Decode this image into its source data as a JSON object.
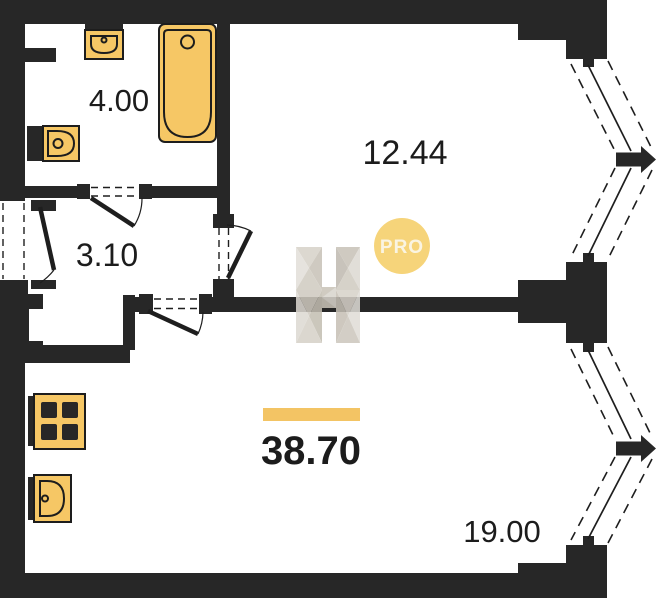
{
  "plan": {
    "type": "apartment-floor-plan",
    "rooms": [
      {
        "id": "bathroom",
        "area_label": "4.00"
      },
      {
        "id": "hallway",
        "area_label": "3.10"
      },
      {
        "id": "room-top",
        "area_label": "12.44"
      },
      {
        "id": "room-bottom",
        "area_label": "19.00"
      },
      {
        "id": "total-area",
        "area_label": "38.70"
      }
    ],
    "fixtures": [
      "bathtub-icon",
      "wash-basin-icon",
      "toilet-icon",
      "stove-icon",
      "kitchen-sink-icon"
    ],
    "windows": [
      "bay-window-top",
      "bay-window-bottom"
    ],
    "doors": [
      "entrance-door",
      "bathroom-door",
      "room-top-door",
      "room-bottom-door"
    ]
  },
  "watermark": {
    "logo_letter": "H",
    "badge_label": "PRO"
  },
  "colors": {
    "wall": "#272727",
    "fixture_fill": "#F6C765",
    "fixture_stroke": "#1D1D1D",
    "area_bar": "#F3C464",
    "badge_bg": "#F6D47A",
    "badge_text": "#FBF8EE",
    "label_text": "#1C1C1C",
    "background": "#FFFFFF",
    "watermark_light": "#E2DFD9",
    "watermark_mid": "#D0CBC1",
    "watermark_dark": "#C3BEB2"
  }
}
